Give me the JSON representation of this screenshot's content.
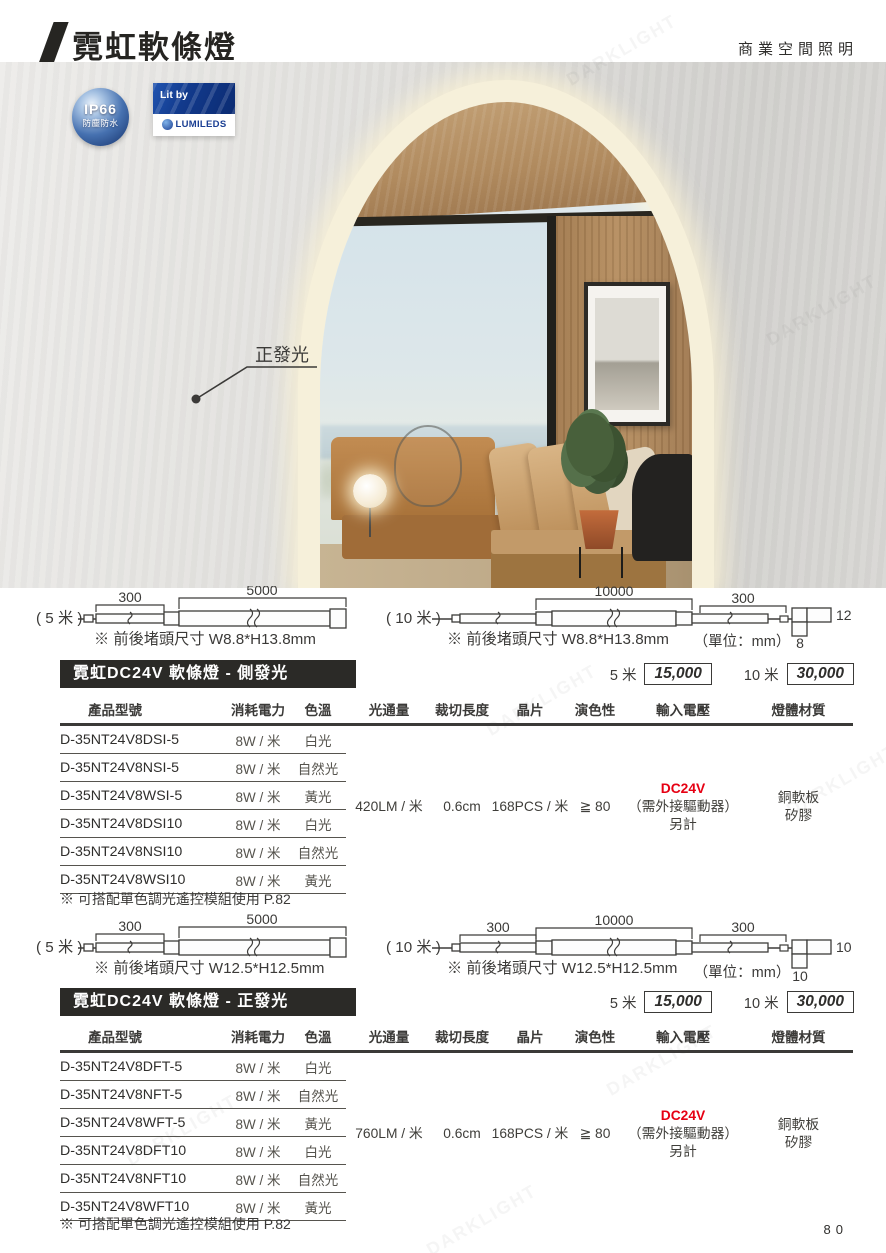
{
  "page": {
    "title": "霓虹軟條燈",
    "top_right": "商業空間照明",
    "page_number": "80",
    "watermark": "DARKLIGHT"
  },
  "badges": {
    "ip66_title": "IP66",
    "ip66_sub": "防塵防水",
    "lit_by": "Lit by",
    "lumileds": "LUMILEDS"
  },
  "photo": {
    "callout": "正發光"
  },
  "diagram_side": {
    "left_label": "( 5 米 )",
    "left_dim_300": "300",
    "left_dim_5000": "5000",
    "left_note": "※ 前後堵頭尺寸 W8.8*H13.8mm",
    "right_label": "( 10 米 )",
    "right_dim_10000": "10000",
    "right_dim_300": "300",
    "right_note": "※ 前後堵頭尺寸 W8.8*H13.8mm",
    "unit": "（單位：mm）",
    "cross_w": "12",
    "cross_h": "8"
  },
  "section_side": {
    "title": "霓虹DC24V 軟條燈 - 側發光",
    "price_5m_label": "5 米",
    "price_5m": "15,000",
    "price_10m_label": "10 米",
    "price_10m": "30,000"
  },
  "table_side": {
    "headers": [
      "產品型號",
      "消耗電力",
      "色溫",
      "光通量",
      "裁切長度",
      "晶片",
      "演色性",
      "輸入電壓",
      "燈體材質"
    ],
    "rows": [
      {
        "model": "D-35NT24V8DSI-5",
        "power": "8W / 米",
        "color": "白光"
      },
      {
        "model": "D-35NT24V8NSI-5",
        "power": "8W / 米",
        "color": "自然光"
      },
      {
        "model": "D-35NT24V8WSI-5",
        "power": "8W / 米",
        "color": "黃光"
      },
      {
        "model": "D-35NT24V8DSI10",
        "power": "8W / 米",
        "color": "白光"
      },
      {
        "model": "D-35NT24V8NSI10",
        "power": "8W / 米",
        "color": "自然光"
      },
      {
        "model": "D-35NT24V8WSI10",
        "power": "8W / 米",
        "color": "黃光"
      }
    ],
    "shared": {
      "lumen": "420LM / 米",
      "cut": "0.6cm",
      "chip": "168PCS / 米",
      "cri": "≧ 80",
      "volt1": "DC24V",
      "volt2": "（需外接驅動器）",
      "volt3": "另計",
      "mat1": "銅軟板",
      "mat2": "矽膠"
    },
    "note": "※ 可搭配單色調光遙控模組使用 P.82"
  },
  "diagram_front": {
    "left_label": "( 5 米 )",
    "left_dim_300": "300",
    "left_dim_5000": "5000",
    "left_note": "※ 前後堵頭尺寸 W12.5*H12.5mm",
    "right_label": "( 10 米 )",
    "right_dim_300a": "300",
    "right_dim_10000": "10000",
    "right_dim_300b": "300",
    "right_note": "※ 前後堵頭尺寸 W12.5*H12.5mm",
    "unit": "（單位：mm）",
    "cross_w": "10",
    "cross_h": "10"
  },
  "section_front": {
    "title": "霓虹DC24V 軟條燈 - 正發光",
    "price_5m_label": "5 米",
    "price_5m": "15,000",
    "price_10m_label": "10 米",
    "price_10m": "30,000"
  },
  "table_front": {
    "headers": [
      "產品型號",
      "消耗電力",
      "色溫",
      "光通量",
      "裁切長度",
      "晶片",
      "演色性",
      "輸入電壓",
      "燈體材質"
    ],
    "rows": [
      {
        "model": "D-35NT24V8DFT-5",
        "power": "8W / 米",
        "color": "白光"
      },
      {
        "model": "D-35NT24V8NFT-5",
        "power": "8W / 米",
        "color": "自然光"
      },
      {
        "model": "D-35NT24V8WFT-5",
        "power": "8W / 米",
        "color": "黃光"
      },
      {
        "model": "D-35NT24V8DFT10",
        "power": "8W / 米",
        "color": "白光"
      },
      {
        "model": "D-35NT24V8NFT10",
        "power": "8W / 米",
        "color": "自然光"
      },
      {
        "model": "D-35NT24V8WFT10",
        "power": "8W / 米",
        "color": "黃光"
      }
    ],
    "shared": {
      "lumen": "760LM / 米",
      "cut": "0.6cm",
      "chip": "168PCS / 米",
      "cri": "≧ 80",
      "volt1": "DC24V",
      "volt2": "（需外接驅動器）",
      "volt3": "另計",
      "mat1": "銅軟板",
      "mat2": "矽膠"
    },
    "note": "※ 可搭配單色調光遙控模組使用 P.82"
  },
  "colors": {
    "accent_red": "#e60013",
    "bar_black": "#2b2a27",
    "glow_cream": "#f6f0da"
  }
}
